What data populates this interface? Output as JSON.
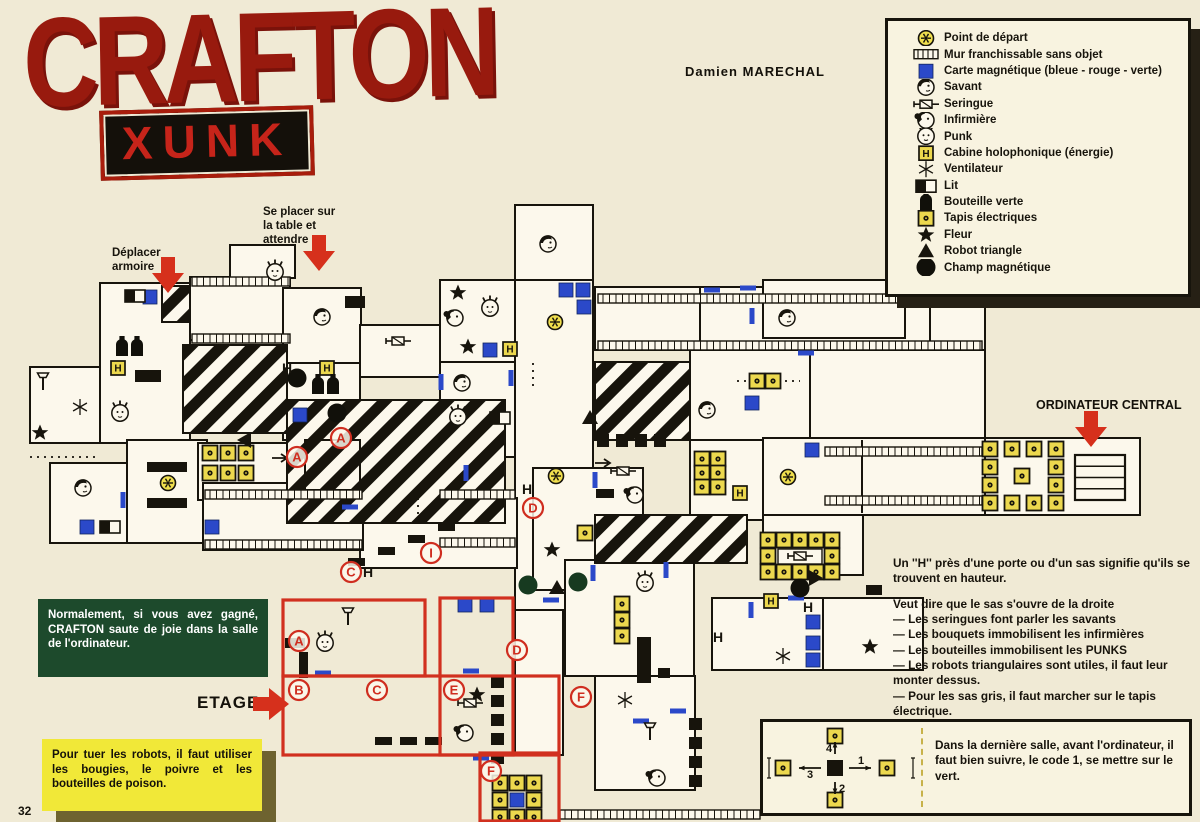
{
  "page": {
    "number": "32",
    "paper": "#f0ead5",
    "ink": "#17140c",
    "red": "#d1301f",
    "blue": "#2b49c9",
    "yellow": "#ecd84e"
  },
  "header": {
    "title": "CRAFTON",
    "amp": "&",
    "subtitle": "XUNK",
    "credit": "Damien MARECHAL"
  },
  "legend": {
    "items": [
      {
        "type": "point",
        "label": "Point de départ"
      },
      {
        "type": "ladder",
        "label": "Mur franchissable sans objet"
      },
      {
        "type": "carte",
        "label": "Carte magnétique (bleue - rouge - verte)"
      },
      {
        "type": "savant",
        "label": "Savant"
      },
      {
        "type": "seringue",
        "label": "Seringue"
      },
      {
        "type": "infirmiere",
        "label": "Infirmière"
      },
      {
        "type": "punk",
        "label": "Punk"
      },
      {
        "type": "cabine",
        "label": "Cabine holophonique (énergie)"
      },
      {
        "type": "vent",
        "label": "Ventilateur"
      },
      {
        "type": "lit",
        "label": "Lit"
      },
      {
        "type": "bottle",
        "label": "Bouteille verte"
      },
      {
        "type": "tapis",
        "label": "Tapis électriques"
      },
      {
        "type": "fleur",
        "label": "Fleur"
      },
      {
        "type": "robot",
        "label": "Robot triangle"
      },
      {
        "type": "champ",
        "label": "Champ magnétique"
      }
    ]
  },
  "annotations": {
    "se_placer": "Se placer sur\nla table et\nattendre",
    "deplacer": "Déplacer\narmoire",
    "ordinateur": "ORDINATEUR CENTRAL",
    "etage": "ETAGE"
  },
  "notes": {
    "green_note": "Normalement, si vous avez gagné, CRAFTON saute de joie dans la salle de l'ordinateur.",
    "yellow_note": "Pour tuer les robots, il faut utiliser les bougies, le poivre et les bouteilles de poison.",
    "h_note": "Un ''H'' près d'une porte ou d'un sas signifie qu'ils se trouvent en hauteur.",
    "rules_intro": "Veut dire que le sas s'ouvre de la droite",
    "rules": [
      "— Les seringues font parler les savants",
      "— Les bouquets immobilisent les infirmières",
      "— Les bouteilles immobilisent les PUNKS",
      "— Les robots triangulaires sont utiles, il faut leur monter dessus.",
      "— Pour les sas gris, il faut marcher sur le tapis électrique.",
      "— Les cartes magnétiques ouvrent les portes de même couleur."
    ],
    "code_note": "Dans la dernière salle, avant l'ordinateur, il faut bien suivre, le code 1, se mettre sur le vert.",
    "code_numbers": [
      "1",
      "2",
      "3",
      "4"
    ]
  },
  "map": {
    "rooms": [
      [
        100,
        283,
        90,
        160
      ],
      [
        30,
        367,
        70,
        76
      ],
      [
        190,
        277,
        100,
        63
      ],
      [
        283,
        288,
        78,
        75
      ],
      [
        230,
        245,
        65,
        33
      ],
      [
        360,
        325,
        80,
        52
      ],
      [
        440,
        280,
        75,
        82
      ],
      [
        515,
        205,
        78,
        77
      ],
      [
        515,
        280,
        78,
        330
      ],
      [
        440,
        362,
        75,
        95
      ],
      [
        50,
        463,
        77,
        80
      ],
      [
        127,
        440,
        80,
        103
      ],
      [
        198,
        443,
        162,
        57
      ],
      [
        283,
        363,
        77,
        77
      ],
      [
        595,
        287,
        390,
        63
      ],
      [
        763,
        280,
        142,
        58
      ],
      [
        690,
        350,
        120,
        90
      ],
      [
        810,
        350,
        175,
        90
      ],
      [
        690,
        440,
        120,
        80
      ],
      [
        763,
        438,
        222,
        77
      ],
      [
        985,
        438,
        155,
        77
      ],
      [
        533,
        468,
        110,
        122
      ],
      [
        360,
        498,
        157,
        70
      ],
      [
        203,
        483,
        160,
        67
      ],
      [
        565,
        560,
        129,
        116
      ],
      [
        712,
        598,
        111,
        72
      ],
      [
        763,
        515,
        100,
        60
      ],
      [
        823,
        598,
        100,
        72
      ],
      [
        595,
        676,
        100,
        114
      ],
      [
        515,
        610,
        48,
        145
      ]
    ],
    "walls": [
      [
        700,
        287,
        700,
        350
      ],
      [
        930,
        287,
        930,
        350
      ],
      [
        862,
        440,
        862,
        513
      ]
    ],
    "red_rooms": [
      [
        283,
        600,
        142,
        76
      ],
      [
        283,
        676,
        276,
        79
      ],
      [
        440,
        598,
        73,
        157
      ],
      [
        480,
        753,
        79,
        68
      ]
    ],
    "hatches": [
      [
        162,
        286,
        28,
        36
      ],
      [
        183,
        345,
        104,
        88
      ],
      [
        287,
        400,
        218,
        123
      ],
      [
        595,
        362,
        95,
        78
      ],
      [
        595,
        515,
        152,
        48
      ],
      [
        305,
        440,
        55,
        50
      ]
    ],
    "ladders": [
      [
        192,
        277,
        98
      ],
      [
        192,
        334,
        98
      ],
      [
        598,
        294,
        384
      ],
      [
        598,
        341,
        384
      ],
      [
        825,
        447,
        157
      ],
      [
        825,
        496,
        157
      ],
      [
        205,
        490,
        157
      ],
      [
        440,
        490,
        75
      ],
      [
        205,
        540,
        157
      ],
      [
        440,
        538,
        75
      ],
      [
        560,
        810,
        200
      ]
    ],
    "sas_h": [
      [
        597,
        440,
        76
      ]
    ],
    "sas_v": [
      [
        497,
        676,
        78
      ],
      [
        695,
        718,
        76
      ]
    ],
    "computer": [
      1075,
      455,
      50,
      45
    ],
    "whiteboxes": [
      [
        778,
        549,
        44,
        15
      ]
    ],
    "bars": [
      [
        147,
        462,
        40,
        10
      ],
      [
        147,
        498,
        40,
        10
      ],
      [
        135,
        370,
        26,
        12
      ],
      [
        345,
        296,
        20,
        12
      ],
      [
        637,
        637,
        14,
        46
      ],
      [
        658,
        668,
        12,
        10
      ],
      [
        285,
        638,
        20,
        10
      ],
      [
        299,
        652,
        9,
        26
      ],
      [
        596,
        489,
        18,
        9
      ],
      [
        866,
        585,
        16,
        10
      ]
    ],
    "dashes": [
      [
        438,
        523
      ],
      [
        408,
        535
      ],
      [
        378,
        547
      ],
      [
        348,
        558
      ],
      [
        375,
        737
      ],
      [
        400,
        737
      ],
      [
        425,
        737
      ]
    ],
    "dotted": [
      [
        533,
        363,
        533,
        390
      ],
      [
        737,
        381,
        752,
        381
      ],
      [
        778,
        381,
        800,
        381
      ],
      [
        418,
        498,
        418,
        524
      ],
      [
        30,
        457,
        100,
        457
      ]
    ],
    "tapis": [
      [
        210,
        453
      ],
      [
        228,
        453
      ],
      [
        246,
        453
      ],
      [
        210,
        473
      ],
      [
        228,
        473
      ],
      [
        246,
        473
      ],
      [
        702,
        459
      ],
      [
        718,
        459
      ],
      [
        702,
        473
      ],
      [
        718,
        473
      ],
      [
        702,
        487
      ],
      [
        718,
        487
      ],
      [
        768,
        540
      ],
      [
        784,
        540
      ],
      [
        800,
        540
      ],
      [
        816,
        540
      ],
      [
        832,
        540
      ],
      [
        768,
        556
      ],
      [
        832,
        556
      ],
      [
        768,
        572
      ],
      [
        784,
        572
      ],
      [
        800,
        572
      ],
      [
        816,
        572
      ],
      [
        832,
        572
      ],
      [
        757,
        381
      ],
      [
        773,
        381
      ],
      [
        622,
        604
      ],
      [
        622,
        620
      ],
      [
        622,
        636
      ],
      [
        585,
        533
      ],
      [
        500,
        783
      ],
      [
        517,
        783
      ],
      [
        534,
        783
      ],
      [
        500,
        800
      ],
      [
        534,
        800
      ],
      [
        500,
        817
      ],
      [
        517,
        817
      ],
      [
        534,
        817
      ],
      [
        990,
        449
      ],
      [
        1012,
        449
      ],
      [
        1034,
        449
      ],
      [
        1056,
        449
      ],
      [
        990,
        467
      ],
      [
        1056,
        467
      ],
      [
        990,
        485
      ],
      [
        1056,
        485
      ],
      [
        990,
        503
      ],
      [
        1012,
        503
      ],
      [
        1034,
        503
      ],
      [
        1056,
        503
      ],
      [
        1022,
        476
      ]
    ],
    "cards": [
      [
        150,
        297
      ],
      [
        566,
        290
      ],
      [
        583,
        290
      ],
      [
        584,
        307
      ],
      [
        490,
        350
      ],
      [
        300,
        415
      ],
      [
        752,
        403
      ],
      [
        812,
        450
      ],
      [
        87,
        527
      ],
      [
        212,
        527
      ],
      [
        813,
        622
      ],
      [
        813,
        643
      ],
      [
        813,
        660
      ],
      [
        465,
        605
      ],
      [
        487,
        605
      ],
      [
        517,
        800
      ]
    ],
    "ticks": [
      [
        350,
        507,
        "h"
      ],
      [
        123,
        500,
        "v"
      ],
      [
        511,
        378,
        "v"
      ],
      [
        441,
        382,
        "v"
      ],
      [
        466,
        473,
        "v"
      ],
      [
        595,
        480,
        "v"
      ],
      [
        666,
        570,
        "v"
      ],
      [
        806,
        353,
        "h"
      ],
      [
        593,
        573,
        "v"
      ],
      [
        751,
        610,
        "v"
      ],
      [
        796,
        598,
        "h"
      ],
      [
        641,
        721,
        "h"
      ],
      [
        678,
        711,
        "h"
      ],
      [
        481,
        758,
        "h"
      ],
      [
        323,
        673,
        "h"
      ],
      [
        471,
        671,
        "h"
      ],
      [
        551,
        600,
        "h"
      ],
      [
        712,
        290,
        "h"
      ],
      [
        748,
        288,
        "h"
      ],
      [
        752,
        316,
        "v"
      ]
    ],
    "points": [
      [
        168,
        483
      ],
      [
        555,
        322
      ],
      [
        556,
        476
      ],
      [
        788,
        477
      ]
    ],
    "cabines": [
      [
        118,
        368
      ],
      [
        327,
        368
      ],
      [
        510,
        349
      ],
      [
        740,
        493
      ],
      [
        771,
        601
      ]
    ],
    "vents": [
      [
        80,
        407
      ],
      [
        625,
        700
      ],
      [
        783,
        656
      ]
    ],
    "fleurs": [
      [
        40,
        433
      ],
      [
        458,
        293
      ],
      [
        468,
        347
      ],
      [
        552,
        550
      ],
      [
        477,
        695
      ],
      [
        870,
        647
      ]
    ],
    "lits": [
      [
        135,
        296
      ],
      [
        110,
        527
      ],
      [
        500,
        418
      ]
    ],
    "bottles": [
      [
        122,
        347
      ],
      [
        137,
        347
      ],
      [
        318,
        385
      ],
      [
        333,
        385
      ]
    ],
    "seringues": [
      [
        398,
        341
      ],
      [
        623,
        471
      ],
      [
        470,
        703
      ],
      [
        800,
        556
      ]
    ],
    "pins": [
      [
        43,
        383
      ],
      [
        348,
        618
      ],
      [
        650,
        733
      ]
    ],
    "savants": [
      [
        322,
        317
      ],
      [
        548,
        244
      ],
      [
        462,
        383
      ],
      [
        83,
        488
      ],
      [
        787,
        318
      ],
      [
        707,
        410
      ]
    ],
    "infirmieres": [
      [
        455,
        318
      ],
      [
        635,
        495
      ],
      [
        465,
        733
      ],
      [
        657,
        778
      ]
    ],
    "punks": [
      [
        120,
        413
      ],
      [
        275,
        272
      ],
      [
        490,
        308
      ],
      [
        458,
        417
      ],
      [
        645,
        583
      ],
      [
        325,
        643
      ]
    ],
    "robots": [
      [
        590,
        418,
        "u"
      ],
      [
        557,
        588,
        "u"
      ],
      [
        815,
        578,
        "r"
      ],
      [
        245,
        440,
        "l"
      ]
    ],
    "champs": [
      [
        297,
        378,
        "#11100a"
      ],
      [
        337,
        413,
        "#11100a"
      ],
      [
        528,
        585,
        "#173a20"
      ],
      [
        578,
        582,
        "#173a20"
      ],
      [
        800,
        588,
        "#11100a"
      ]
    ],
    "letters": [
      [
        "A",
        297,
        457
      ],
      [
        "A",
        341,
        438
      ],
      [
        "C",
        351,
        572
      ],
      [
        "I",
        431,
        553
      ],
      [
        "D",
        533,
        508
      ],
      [
        "A",
        299,
        641
      ],
      [
        "B",
        299,
        690
      ],
      [
        "C",
        377,
        690
      ],
      [
        "D",
        517,
        650
      ],
      [
        "E",
        454,
        690
      ],
      [
        "F",
        491,
        771
      ],
      [
        "F",
        581,
        697
      ]
    ],
    "hlabels": [
      [
        287,
        368
      ],
      [
        368,
        572
      ],
      [
        527,
        489
      ],
      [
        718,
        637
      ],
      [
        808,
        607
      ]
    ],
    "arrows": [
      [
        280,
        458
      ],
      [
        603,
        463
      ]
    ]
  }
}
